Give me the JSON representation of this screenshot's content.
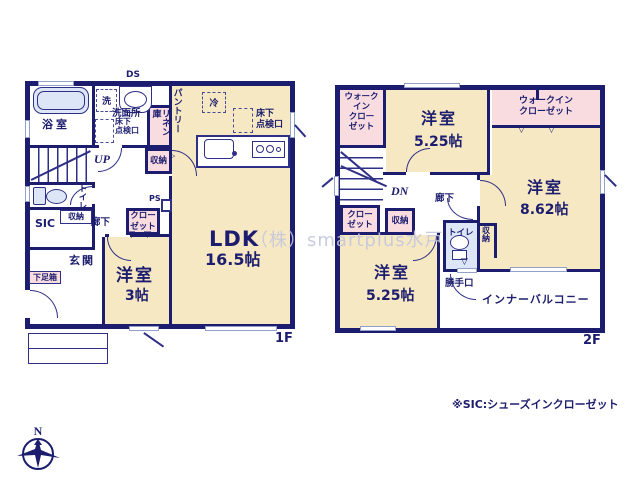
{
  "palette": {
    "wall": "#1c1d6e",
    "room": "#f7e8c4",
    "closet": "#f9dce0",
    "wet": "#dce6f6",
    "window": "#93a0c8",
    "text": "#1c1d6e"
  },
  "watermark": "（株）smartplus水戸",
  "footnote": "※SIC:シューズインクローゼット",
  "compass": {
    "north": "N"
  },
  "floor1": {
    "label": "1F",
    "rooms": {
      "ds": "DS",
      "washer": "洗",
      "washroom": "洗面所",
      "underfloor_wash": "床下\n点検口",
      "linen": "リネン\n庫",
      "bath": "浴室",
      "pantry": "パントリー",
      "fridge": "冷",
      "underfloor_ldk": "床下\n点検口",
      "up": "UP",
      "storage_mid": "収納",
      "ps": "PS",
      "toilet": "トイレ",
      "storage_hall": "収納",
      "sic": "SIC",
      "hallway": "廊下",
      "closet": "クロー\nゼット",
      "entrance": "玄関",
      "shoebox": "下足箱",
      "ldk_name": "LDK",
      "ldk_size": "16.5帖",
      "west_room_name": "洋室",
      "west_room_size": "3帖"
    }
  },
  "floor2": {
    "label": "2F",
    "rooms": {
      "wic_left": "ウォーク\nイン\nクロー\nゼット",
      "room_n_name": "洋室",
      "room_n_size": "5.25帖",
      "wic_right": "ウォークイン\nクローゼット",
      "room_e_name": "洋室",
      "room_e_size": "8.62帖",
      "dn": "DN",
      "hallway": "廊下",
      "closet": "クロー\nゼット",
      "storage": "収納",
      "room_s_name": "洋室",
      "room_s_size": "5.25帖",
      "toilet": "トイレ",
      "storage_e": "収納",
      "backdoor": "勝手口",
      "balcony": "インナーバルコニー"
    }
  }
}
